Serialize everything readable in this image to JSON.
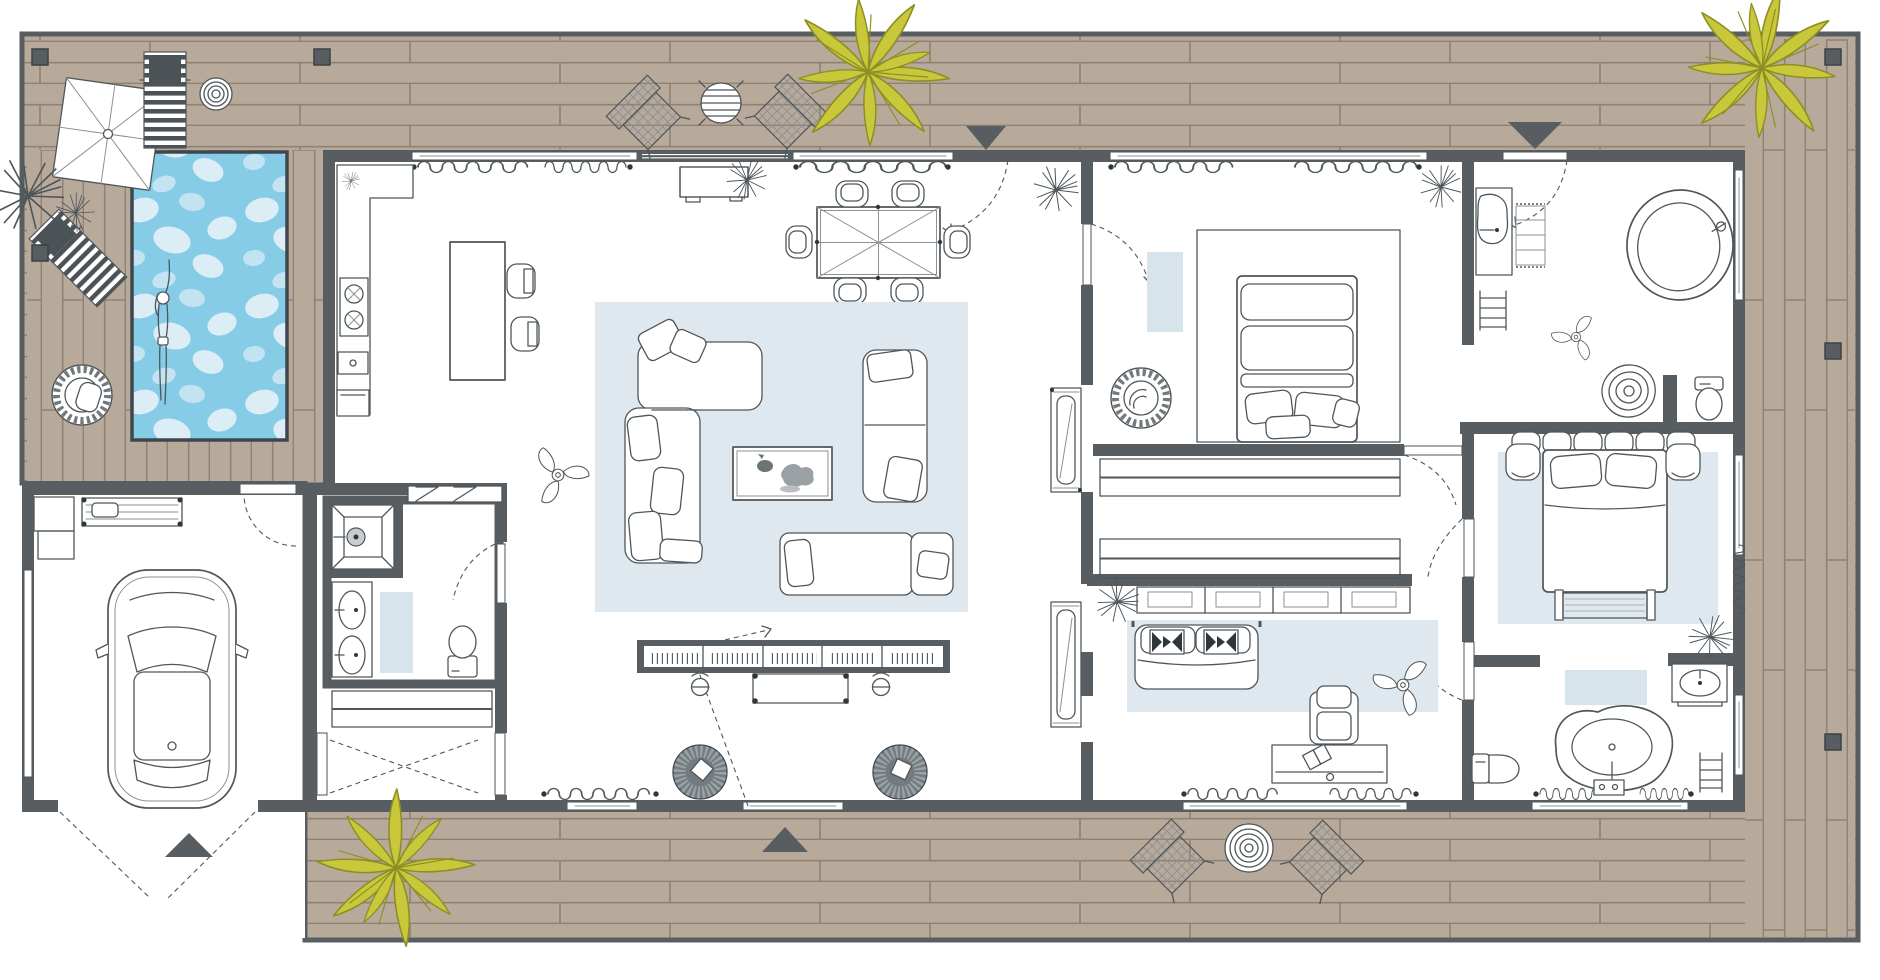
{
  "title": "Architectural floor plan of a modern single-storey villa with pool deck, top view",
  "colors": {
    "wall": "#575d60",
    "line": "#4f565a",
    "linesoft": "#8b9196",
    "deck": "#b8aa9b",
    "deckline": "#8f8274",
    "pool": "#86cce6",
    "poolblob": "#dcedf6",
    "poolblob2": "#c2e4f2",
    "pooledge": "#3f474c",
    "rug": "#dfe8ee",
    "mat": "#d8e4eb",
    "palm": "#c9c83b",
    "palmdark": "#8d8f24"
  },
  "rooms": [
    {
      "name": "pool-terrace",
      "items": [
        "swimming-pool",
        "swimmer",
        "parasol",
        "sun-lounger",
        "sun-lounger-diagonal",
        "round-coil-table",
        "papasan-chair",
        "terrace-plants"
      ]
    },
    {
      "name": "wood-deck",
      "items": [
        "plank-decking",
        "deck-lights",
        "entrance-markers",
        "palm-plants",
        "outdoor-table-set",
        "woven-deck-chairs",
        "round-coil-mat"
      ]
    },
    {
      "name": "garage",
      "items": [
        "car",
        "workbench",
        "storage-rack",
        "side-window",
        "driveway"
      ]
    },
    {
      "name": "kitchen",
      "items": [
        "counter",
        "cooktop",
        "sink",
        "oven",
        "island",
        "bar-stools"
      ]
    },
    {
      "name": "dining-area",
      "items": [
        "dining-table",
        "six-chairs",
        "sideboard",
        "plant"
      ]
    },
    {
      "name": "living-room",
      "items": [
        "area-rug",
        "corner-sofa",
        "sofa",
        "daybed",
        "coffee-table",
        "ceiling-fan",
        "media-console",
        "speakers",
        "woven-basket",
        "round-poufs",
        "tall-cabinets"
      ]
    },
    {
      "name": "guest-bathroom",
      "items": [
        "shower",
        "double-sink-vanity",
        "toilet",
        "bath-mat",
        "overhead-cabinet"
      ]
    },
    {
      "name": "entry-vestibule",
      "items": [
        "double-doors",
        "coat-rail"
      ]
    },
    {
      "name": "bedroom-1",
      "items": [
        "double-bed",
        "wood-grain-rug",
        "papasan-chair",
        "bedside-mat",
        "plant"
      ]
    },
    {
      "name": "walk-in-closet",
      "items": [
        "clothes-rail-1",
        "clothes-rail-2",
        "pocket-doors"
      ]
    },
    {
      "name": "bathroom-1",
      "items": [
        "oval-bathtub",
        "vanity-sink",
        "towel-shelf",
        "ladder-rack",
        "ceiling-fan",
        "spiral-rug",
        "toilet"
      ]
    },
    {
      "name": "bedroom-2",
      "items": [
        "double-bed",
        "headboard-cushions",
        "bedside-tables",
        "foot-bench",
        "area-rug",
        "corner-plant"
      ]
    },
    {
      "name": "media-room",
      "items": [
        "sofa-with-kilim-pillows",
        "area-rug",
        "armchair",
        "writing-desk",
        "open-book",
        "ceiling-fan",
        "folded-clothes-shelf",
        "plant"
      ]
    },
    {
      "name": "bathroom-2",
      "items": [
        "stone-bathtub",
        "vanity-sink",
        "toilet",
        "ladder-rack",
        "bath-mat"
      ]
    }
  ],
  "markers": {
    "deck_lights": 6,
    "entrance_triangles": 4,
    "palm_plants": 3,
    "ceiling_fans": 3
  }
}
